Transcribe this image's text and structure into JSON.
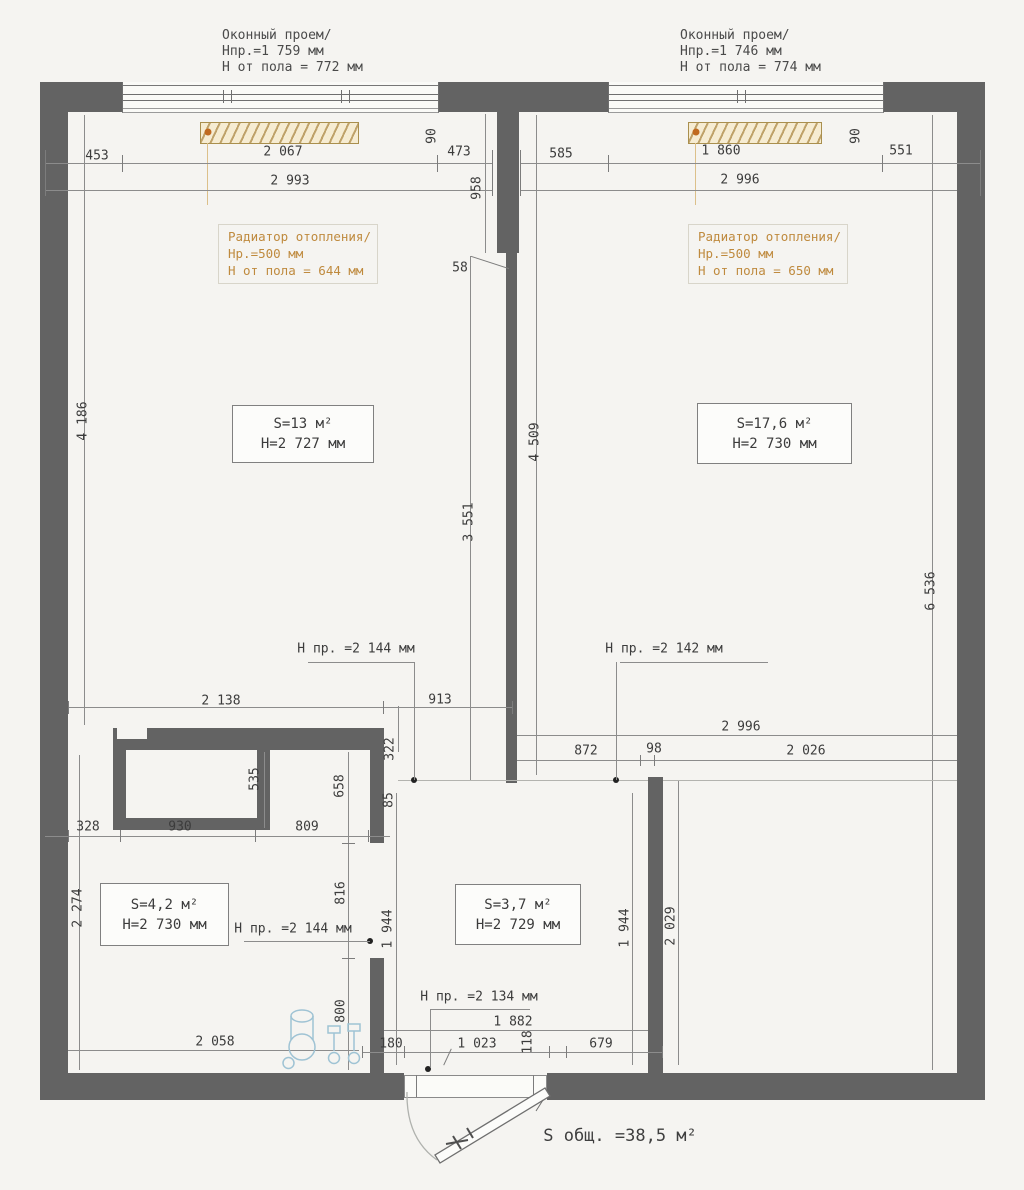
{
  "drawing": {
    "window_left": {
      "l1": "Оконный проем/",
      "l2": "Hпр.=1 759 мм",
      "l3": "H от пола = 772 мм"
    },
    "window_right": {
      "l1": "Оконный проем/",
      "l2": "Hпр.=1 746 мм",
      "l3": "H от пола = 774 мм"
    },
    "radiator_left": {
      "l1": "Радиатор отопления/",
      "l2": "Hр.=500 мм",
      "l3": "H от пола = 644 мм"
    },
    "radiator_right": {
      "l1": "Радиатор отопления/",
      "l2": "Hр.=500 мм",
      "l3": "H от пола = 650 мм"
    },
    "room_living": {
      "area": "S=13 м²",
      "height": "H=2 727 мм"
    },
    "room_bedroom": {
      "area": "S=17,6 м²",
      "height": "H=2 730 мм"
    },
    "room_bath": {
      "area": "S=4,2 м²",
      "height": "H=2 730 мм"
    },
    "room_hall": {
      "area": "S=3,7 м²",
      "height": "H=2 729 мм"
    },
    "openings": {
      "o1": "H пр. =2 144 мм",
      "o2": "H пр. =2 142 мм",
      "o3": "H пр. =2 144 мм",
      "o4": "H пр. =2 134 мм"
    },
    "total": "S общ. =38,5 м²",
    "dims": {
      "d453": "453",
      "d2067": "2 067",
      "d473": "473",
      "d2993": "2 993",
      "d90l": "90",
      "d585": "585",
      "d1860": "1 860",
      "d551": "551",
      "d2996t": "2 996",
      "d90r": "90",
      "d958": "958",
      "d58": "58",
      "d4186": "4 186",
      "d3551": "3 551",
      "d4509": "4 509",
      "d6536": "6 536",
      "d2138": "2 138",
      "d913": "913",
      "d322": "322",
      "d2996b": "2 996",
      "d872": "872",
      "d98": "98",
      "d2026": "2 026",
      "d535": "535",
      "d658": "658",
      "d85": "85",
      "d328": "328",
      "d930": "930",
      "d809": "809",
      "d2274": "2 274",
      "d816": "816",
      "d800": "800",
      "d2058": "2 058",
      "d1944l": "1 944",
      "d1944r": "1 944",
      "d2029": "2 029",
      "d180": "180",
      "d1882": "1 882",
      "d1023": "1 023",
      "d118": "118",
      "d679": "679"
    }
  },
  "colors": {
    "wall": "#636363",
    "radiator_text": "#bf8a3e",
    "radiator_fill": "#f6ecd2",
    "plumbing": "#9fc3d4",
    "dimension_text": "#3c3c3c"
  }
}
